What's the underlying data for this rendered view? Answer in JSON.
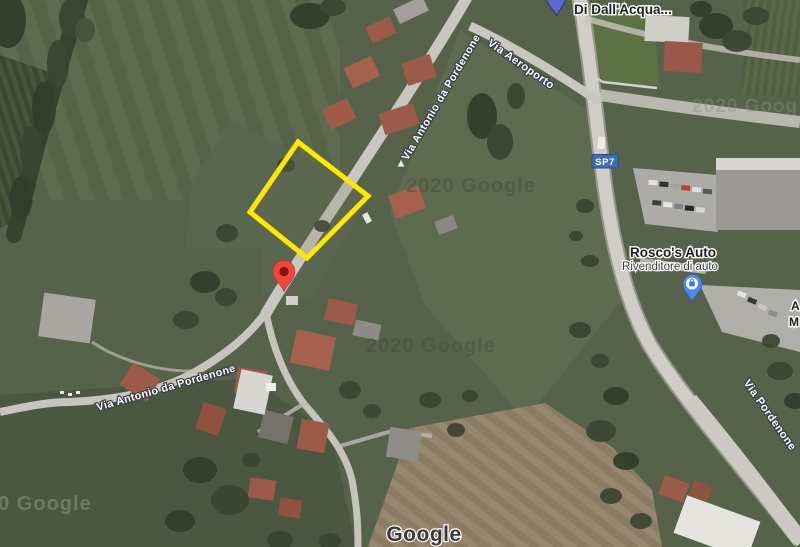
{
  "colors": {
    "parcel_outline": "#FFE800",
    "red_pin": "#F0453A",
    "red_pin_dot": "#7F150D",
    "business_pin": "#4E86F7",
    "poi_pin_top": "#5A6BC9",
    "route_badge_bg": "#3E6DB5"
  },
  "labels": {
    "poi_top": "Di Dall'Acqua...",
    "road_via_aeroporto": "Via Aeroporto",
    "road_via_antonio_upper": "Via Antonio da Pordenone",
    "road_via_antonio_lower": "Via Antonio da Pordenone",
    "road_via_pordenone": "Via Pordenone",
    "route_badge": "SP7",
    "business_name": "Rosco's Auto",
    "business_subtitle": "Rivenditore di auto",
    "edge_label_line1": "A",
    "edge_label_line2": "M"
  },
  "watermarks": {
    "center_upper": "2020 Google",
    "center_lower": "2020 Google",
    "bottom_left_partial": "20 Google",
    "top_right_partial": "2020 Goog",
    "logo": "Google"
  }
}
